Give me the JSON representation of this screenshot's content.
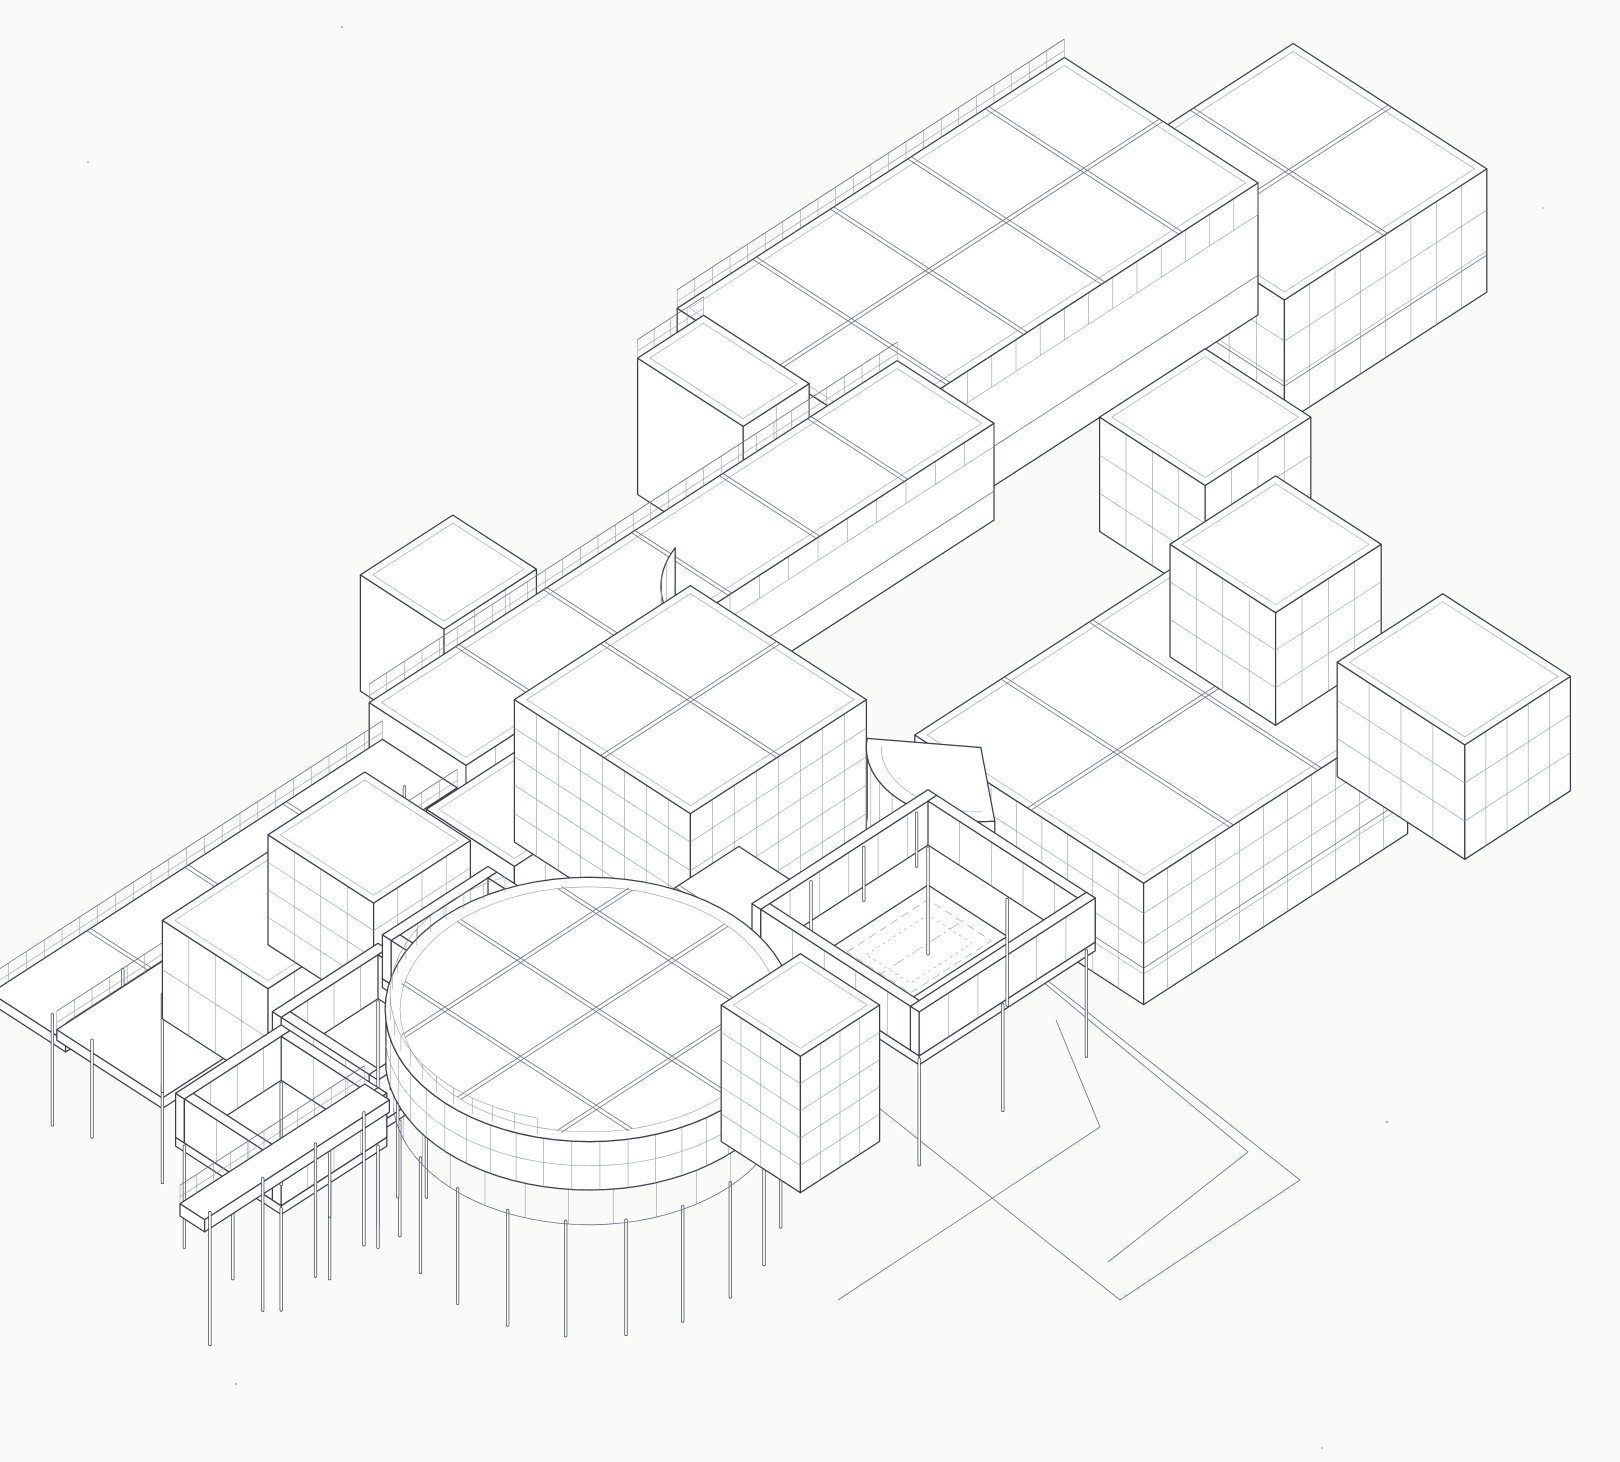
{
  "page": {
    "background": "#fafaf9",
    "paper": "#ffffff"
  },
  "drawing": {
    "kind": "axonometric-architectural-line-drawing",
    "colors": {
      "ink": "#3a3f4a",
      "mid": "#6a7080",
      "fine": "#9096a2",
      "paper": "#ffffff",
      "background": "#fafaf9"
    },
    "projection": {
      "ox": 70,
      "oy": 845,
      "ax": 88,
      "by": 57,
      "cz": 88
    },
    "shapes": [
      {
        "t": "speck",
        "name": "paper-speckle",
        "x": 342,
        "y": 27,
        "r": 1.2
      },
      {
        "t": "speck",
        "name": "paper-speckle",
        "x": 1543,
        "y": 208,
        "r": 1.0
      },
      {
        "t": "speck",
        "name": "paper-speckle",
        "x": 88,
        "y": 162,
        "r": 1.0
      },
      {
        "t": "box",
        "name": "far-right-upper-block",
        "x": 10.6,
        "y": 1.0,
        "w": 2.3,
        "d": 2.2,
        "h": 1.4,
        "par": 1,
        "rg": [
          2,
          2
        ],
        "lg": [
          7,
          3
        ],
        "rgt": [
          8,
          3
        ],
        "sl": 1
      },
      {
        "t": "box",
        "name": "north-wing",
        "x": 7.0,
        "y": -0.1,
        "w": 4.4,
        "d": 2.2,
        "h": 1.5,
        "par": 1,
        "rg": [
          5,
          2
        ],
        "rgt": [
          16,
          0,
          1
        ],
        "sl": 1,
        "railN": 1
      },
      {
        "t": "box",
        "name": "north-wing-west-cap",
        "x": 6.3,
        "y": 0.15,
        "w": 0.75,
        "d": 1.2,
        "h": 1.55,
        "par": 1,
        "rgt": [
          2,
          2
        ],
        "railN": 1
      },
      {
        "t": "box",
        "name": "upper-left-block",
        "x": 3.0,
        "y": 0.3,
        "w": 1.05,
        "d": 0.95,
        "h": 1.32,
        "par": 1,
        "rg": [
          1,
          1
        ],
        "rgt": [
          3,
          2
        ]
      },
      {
        "t": "box",
        "name": "spine-bar",
        "x": 2.1,
        "y": 1.3,
        "w": 6.0,
        "d": 1.1,
        "h": 1.1,
        "par": 1,
        "rg": [
          6,
          1
        ],
        "rgt": [
          18,
          0,
          1
        ],
        "railN": 1,
        "sl": 1
      },
      {
        "t": "poly",
        "name": "plaza-outline",
        "pts": [
          [
            952,
            905
          ],
          [
            1300,
            1180
          ],
          [
            1120,
            1300
          ],
          [
            800,
            1045
          ]
        ],
        "close": 1
      },
      {
        "t": "poly",
        "name": "plaza-inner-line",
        "pts": [
          [
            966,
            918
          ],
          [
            1248,
            1152
          ],
          [
            1108,
            1262
          ]
        ]
      },
      {
        "t": "poly",
        "name": "walkway-line",
        "pts": [
          [
            1056,
            1020
          ],
          [
            1100,
            1127
          ],
          [
            838,
            1300
          ]
        ]
      },
      {
        "t": "slab",
        "name": "west-bridge-slab",
        "x": -2.35,
        "y": 1.45,
        "w": 4.45,
        "d": 0.85,
        "zt": 0.78,
        "th": 0.12,
        "railN": 1,
        "railS": 1,
        "rg": [
          4,
          1
        ],
        "posts": [
          [
            -2.1,
            1.9
          ],
          [
            -1.3,
            1.9
          ],
          [
            -0.5,
            1.9
          ],
          [
            0.3,
            1.9
          ],
          [
            1.1,
            1.9
          ],
          [
            1.9,
            1.9
          ]
        ],
        "plen": 1.25
      },
      {
        "t": "slab",
        "name": "west-terrace-slab",
        "x": -2.25,
        "y": 2.1,
        "w": 1.2,
        "d": 1.2,
        "zt": 0.72,
        "th": 0.12,
        "railN": 1,
        "posts": [
          [
            -2.05,
            2.3
          ],
          [
            -2.05,
            3.1
          ],
          [
            -1.25,
            2.3
          ],
          [
            -1.25,
            3.1
          ]
        ],
        "plen": 1.1
      },
      {
        "t": "box",
        "name": "west-roof-block",
        "x": -1.0,
        "y": 2.05,
        "w": 1.2,
        "d": 1.2,
        "h": 1.12,
        "par": 1,
        "rg": [
          1,
          1
        ],
        "lg": [
          4,
          2
        ],
        "rgt": [
          4,
          2
        ]
      },
      {
        "t": "box",
        "name": "west-mid-block",
        "x": 1.45,
        "y": 2.6,
        "w": 1.05,
        "d": 1.0,
        "h": 1.15,
        "par": 1,
        "rg": [
          1,
          1
        ],
        "rgt": [
          3,
          2
        ]
      },
      {
        "t": "box",
        "name": "west-grid-block",
        "x": 0.25,
        "y": 2.0,
        "w": 1.1,
        "d": 1.2,
        "h": 1.25,
        "par": 1,
        "rg": [
          1,
          1
        ],
        "lg": [
          4,
          4
        ],
        "rgt": [
          4,
          4
        ]
      },
      {
        "t": "arc",
        "name": "concave-glass-wall",
        "cx": 5.15,
        "cy": 3.05,
        "r": 1.05,
        "a0": 140,
        "a1": 252,
        "z0": 0.45,
        "z1": 1.58,
        "ticks": 11
      },
      {
        "t": "box",
        "name": "central-grid-block",
        "x": 2.55,
        "y": 2.5,
        "w": 2.0,
        "d": 2.0,
        "h": 1.62,
        "par": 1,
        "rg": [
          2,
          2
        ],
        "lg": [
          8,
          5
        ],
        "rgt": [
          8,
          5
        ]
      },
      {
        "t": "box",
        "name": "east-upper-block",
        "x": 8.6,
        "y": 3.1,
        "w": 1.2,
        "d": 1.2,
        "h": 1.3,
        "par": 1,
        "rg": [
          1,
          1
        ],
        "lg": [
          4,
          3
        ],
        "rgt": [
          4,
          3
        ]
      },
      {
        "t": "box",
        "name": "east-wing",
        "x": 4.7,
        "y": 4.9,
        "w": 3.0,
        "d": 2.6,
        "h": 1.38,
        "par": 1,
        "rg": [
          3,
          2
        ],
        "lg": [
          9,
          4
        ],
        "rgt": [
          11,
          4
        ],
        "sl": 1
      },
      {
        "t": "box",
        "name": "east-south-block",
        "x": 7.9,
        "y": 4.6,
        "w": 1.2,
        "d": 1.2,
        "h": 1.28,
        "par": 1,
        "rg": [
          1,
          1
        ],
        "lg": [
          4,
          3
        ],
        "rgt": [
          4,
          3
        ]
      },
      {
        "t": "arc",
        "name": "fan-canopy",
        "cx": 4.95,
        "cy": 5.4,
        "r": 0.92,
        "a0": 128,
        "a1": 232,
        "z0": 0.5,
        "z1": 1.4,
        "ticks": 9,
        "roof": 1
      },
      {
        "t": "box",
        "name": "east-corner-block",
        "x": 7.8,
        "y": 6.6,
        "w": 1.2,
        "d": 1.45,
        "h": 1.3,
        "par": 1,
        "rg": [
          1,
          1
        ],
        "lg": [
          4,
          3
        ],
        "rgt": [
          5,
          3
        ]
      },
      {
        "t": "slab",
        "name": "drum-link-roof",
        "x": 1.6,
        "y": 4.6,
        "w": 1.4,
        "d": 0.85,
        "zt": 1.02,
        "th": 0.14,
        "rg": [
          2,
          1
        ]
      },
      {
        "t": "court",
        "name": "west-court-a",
        "x": -1.1,
        "y": 3.4,
        "w": 1.2,
        "d": 1.2,
        "fz": 0.52,
        "wh": 0.5,
        "plen": 1.15
      },
      {
        "t": "court",
        "name": "west-court-b",
        "x": 0.2,
        "y": 3.35,
        "w": 1.2,
        "d": 1.2,
        "fz": 0.52,
        "wh": 0.5,
        "plen": 1.15
      },
      {
        "t": "court",
        "name": "west-court-c",
        "x": -2.35,
        "y": 3.55,
        "w": 1.2,
        "d": 1.2,
        "fz": 0.5,
        "wh": 0.5,
        "plen": 1.15
      },
      {
        "t": "court",
        "name": "pool-court",
        "x": 2.55,
        "y": 5.2,
        "w": 2.0,
        "d": 1.9,
        "fz": 0.55,
        "wh": 0.5,
        "plen": 1.2,
        "pool": {
          "x": 3.0,
          "y": 5.65,
          "w": 1.1,
          "d": 0.9
        },
        "stubs": [
          [
            3.0,
            5.42,
            0.6
          ],
          [
            3.6,
            5.42,
            0.6
          ],
          [
            4.2,
            5.42,
            0.6
          ]
        ]
      },
      {
        "t": "drum",
        "name": "rotunda",
        "cx": 0.35,
        "cy": 5.55,
        "r": 1.58,
        "fz": 0.5,
        "bz": 0.95,
        "tz": 1.5,
        "beams": [
          -0.82,
          0.04,
          0.9
        ],
        "plen": 1.3
      },
      {
        "t": "box",
        "name": "rotunda-core-block",
        "x": 1.1,
        "y": 6.3,
        "w": 0.9,
        "d": 0.9,
        "h": 1.55,
        "par": 1,
        "lg": [
          4,
          5
        ],
        "rgt": [
          4,
          5
        ]
      },
      {
        "t": "slab",
        "name": "southwest-bridge",
        "x": -3.1,
        "y": 4.35,
        "w": 2.1,
        "d": 0.28,
        "zt": 0.75,
        "th": 0.14,
        "railN": 1,
        "posts": [
          [
            -2.9,
            4.49
          ],
          [
            -2.3,
            4.49
          ],
          [
            -1.7,
            4.49
          ],
          [
            -1.15,
            4.49
          ]
        ],
        "plen": 1.5
      },
      {
        "t": "speck",
        "name": "paper-speckle",
        "x": 1387,
        "y": 1122,
        "r": 1.4
      },
      {
        "t": "speck",
        "name": "paper-speckle",
        "x": 236,
        "y": 1384,
        "r": 1.2
      },
      {
        "t": "speck",
        "name": "paper-speckle",
        "x": 1322,
        "y": 1448,
        "r": 1.1
      }
    ]
  }
}
